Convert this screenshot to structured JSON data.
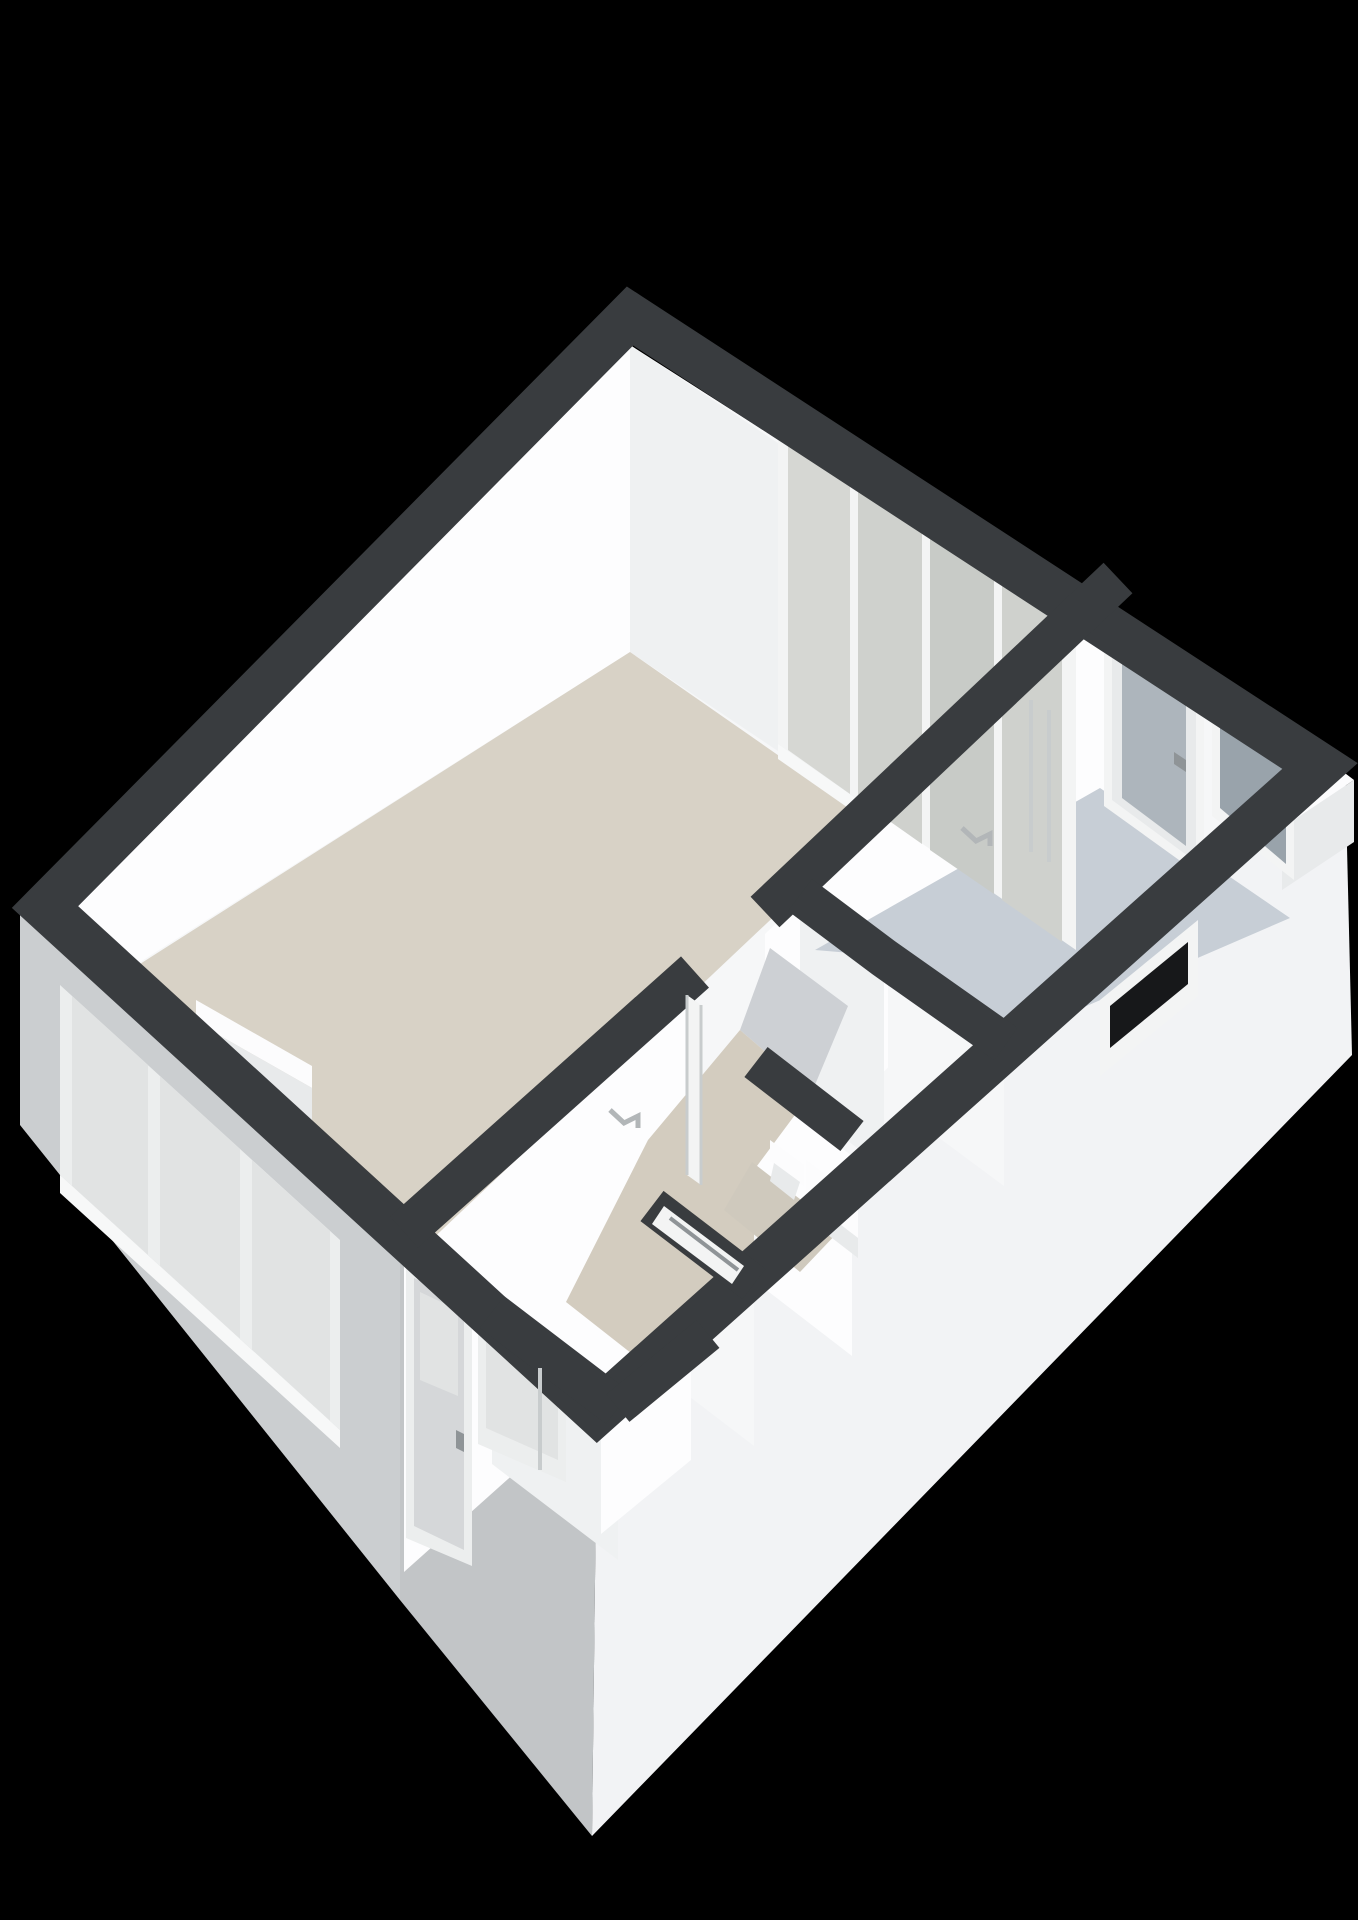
{
  "scene": {
    "kind": "3d-floorplan-isometric-render",
    "background": "#000000",
    "view": "cutaway apartment floor plan seen from above at an angle, walls cut flat with dark tops, building floating on black"
  },
  "palette": {
    "background": "#000000",
    "band": "#393c3f",
    "bandSoft": "#43464a",
    "wallBase": "#f6f7f8",
    "wallBright": "#fdfdfe",
    "wallShaded": "#eff1f2",
    "wallDim": "#e7e9ea",
    "extSW": "#cbced0",
    "extSWDark": "#c2c5c7",
    "extSE": "#f2f3f5",
    "floorLiving": "#d8d2c6",
    "floorHall": "#d3ccbf",
    "floorHallTop": "#cdd0d4",
    "floorBath": "#c7ced6",
    "floorToilet": "#cfc9bd",
    "frameWhite": "#f3f4f4",
    "frameExt": "#eceeee",
    "sill": "#f7f8f8",
    "glassFrost": "#d6d7d3",
    "glassFrostMid": "#cfd1cd",
    "glassFrostDim": "#c8cbc7",
    "glassExt": "#e1e3e3",
    "glassDoor": "#adb5bc",
    "glassWin": "#99a3ab",
    "glassBlack": "#17181a",
    "doorLeaf": "#d5d7d9",
    "fixtureWhite": "#fcfcfd",
    "fixtureShade": "#e8eaeb",
    "lineGray": "#c8cccd",
    "handleGray": "#b2b6b8",
    "knobGray": "#8f9497"
  },
  "rooms": [
    {
      "id": "living-room",
      "label": "large living room",
      "floor": "beige",
      "floor_color_key": "floorLiving"
    },
    {
      "id": "hallway",
      "label": "hallway corridor",
      "floor": "beige",
      "floor_color_key": "floorHall"
    },
    {
      "id": "toilet",
      "label": "toilet room",
      "floor": "beige-gray",
      "floor_color_key": "floorToilet"
    },
    {
      "id": "bathroom",
      "label": "bathroom / balcony room",
      "floor": "light blue-gray",
      "floor_color_key": "floorBath"
    },
    {
      "id": "entry-vestibule",
      "label": "entry vestibule at south corner",
      "floor": "gray",
      "floor_color_key": "floorToilet"
    }
  ],
  "features": [
    {
      "id": "living-room-window-wall",
      "desc": "frosted window band with white mullions on the top-right wall of the living room",
      "panes": 4
    },
    {
      "id": "side-window-wall",
      "desc": "three exterior windows on the lower-left facade",
      "panes": 3
    },
    {
      "id": "bathroom-glass-door",
      "desc": "glazed door with frosted glass and handle on bathroom rear wall"
    },
    {
      "id": "bathroom-frosted-window",
      "desc": "frosted window right of the bathroom glass door"
    },
    {
      "id": "bathroom-exterior-window",
      "desc": "small dark window opening on the lower-right facade"
    },
    {
      "id": "front-door",
      "desc": "entry door with small glass pane and handle on lower-left facade"
    },
    {
      "id": "narrow-window",
      "desc": "narrow horizontal window beside the front door"
    },
    {
      "id": "sliding-door-living",
      "desc": "parked sliding door leaf with handle on living-room side of the long interior wall"
    },
    {
      "id": "sliding-door-bathroom",
      "desc": "sliding door lines with handle on bathroom side of the long interior wall"
    },
    {
      "id": "toilet-fixture",
      "desc": "white toilet in the small toilet room"
    },
    {
      "id": "bathroom-counter",
      "desc": "white counter slab in the east bathroom corner"
    },
    {
      "id": "window-frame-top-view",
      "desc": "white window frame seen from above inside a cut wall near the entry"
    },
    {
      "id": "window-bench",
      "desc": "low white sill bench under the living-room side windows"
    }
  ]
}
